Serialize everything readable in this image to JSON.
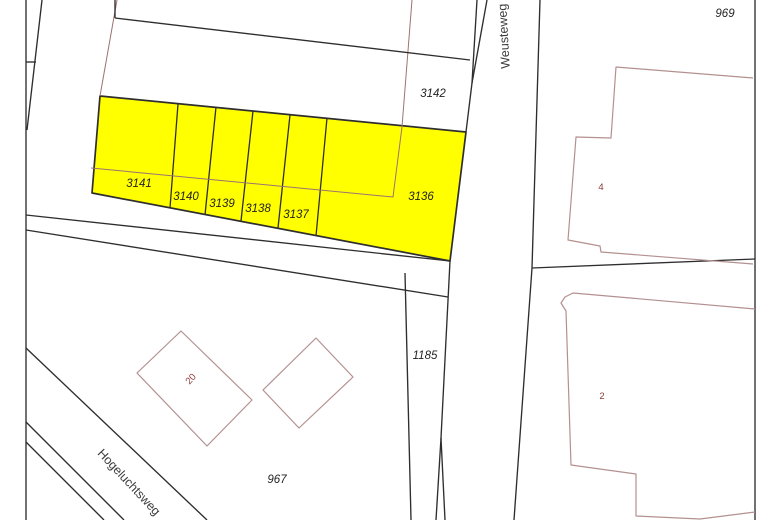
{
  "map": {
    "canvas": {
      "width": 780,
      "height": 520,
      "background": "#ffffff"
    },
    "colors": {
      "boundary": "#2e2e2e",
      "red_line": "#9b7272",
      "building": "#b49090",
      "highlight": "#ffff00",
      "parcel_label": "#232323",
      "house_label": "#8e3b3b",
      "street_label": "#3d3d3d"
    },
    "highlight": {
      "points": [
        [
          100,
          96
        ],
        [
          466,
          132
        ],
        [
          450,
          261
        ],
        [
          92,
          193
        ]
      ],
      "dividers": [
        [
          [
            178,
            104
          ],
          [
            170,
            208
          ]
        ],
        [
          [
            216,
            107
          ],
          [
            205,
            215
          ]
        ],
        [
          [
            253,
            111
          ],
          [
            241,
            221
          ]
        ],
        [
          [
            290,
            115
          ],
          [
            278,
            228
          ]
        ],
        [
          [
            327,
            118
          ],
          [
            316,
            236
          ]
        ]
      ]
    },
    "black_lines": [
      {
        "name": "left-boundary-vertical",
        "points": [
          [
            26,
            0
          ],
          [
            26,
            520
          ]
        ]
      },
      {
        "name": "left-diagonal",
        "points": [
          [
            42,
            0
          ],
          [
            27,
            130
          ]
        ]
      },
      {
        "name": "left-tick",
        "points": [
          [
            26,
            62
          ],
          [
            36,
            62
          ]
        ]
      },
      {
        "name": "top-left-vertical-tick",
        "points": [
          [
            115,
            0
          ],
          [
            115,
            18
          ]
        ]
      },
      {
        "name": "upper-parcel-boundary",
        "points": [
          [
            115,
            18
          ],
          [
            470,
            60
          ]
        ]
      },
      {
        "name": "road-left-edge-upper-a",
        "points": [
          [
            477,
            0
          ],
          [
            472,
            83
          ],
          [
            466,
            132
          ]
        ]
      },
      {
        "name": "road-left-edge-upper-b",
        "points": [
          [
            487,
            0
          ],
          [
            472,
            83
          ]
        ]
      },
      {
        "name": "road-right-edge",
        "points": [
          [
            540,
            0
          ],
          [
            532,
            268
          ],
          [
            514,
            520
          ]
        ]
      },
      {
        "name": "boundary-right-of-road",
        "points": [
          [
            532,
            268
          ],
          [
            755,
            259
          ]
        ]
      },
      {
        "name": "right-boundary-vertical",
        "points": [
          [
            755,
            0
          ],
          [
            755,
            520
          ]
        ]
      },
      {
        "name": "strip-line-a",
        "points": [
          [
            26,
            215
          ],
          [
            450,
            261
          ]
        ]
      },
      {
        "name": "strip-line-b",
        "points": [
          [
            26,
            230
          ],
          [
            448,
            297
          ]
        ]
      },
      {
        "name": "road-left-edge-lower",
        "points": [
          [
            450,
            261
          ],
          [
            441,
            438
          ],
          [
            445,
            520
          ]
        ]
      },
      {
        "name": "fork-branch-left",
        "points": [
          [
            441,
            438
          ],
          [
            436,
            520
          ]
        ]
      },
      {
        "name": "parcel-1185-left-boundary",
        "points": [
          [
            405,
            273
          ],
          [
            411,
            520
          ]
        ]
      },
      {
        "name": "hogeluchtsweg-edge-1",
        "points": [
          [
            26,
            348
          ],
          [
            207,
            520
          ]
        ]
      },
      {
        "name": "hogeluchtsweg-edge-2",
        "points": [
          [
            26,
            422
          ],
          [
            124,
            520
          ]
        ]
      },
      {
        "name": "hogeluchtsweg-edge-3",
        "points": [
          [
            26,
            442
          ],
          [
            104,
            520
          ]
        ]
      }
    ],
    "red_lines": [
      {
        "name": "red-boundary-left",
        "points": [
          [
            117,
            0
          ],
          [
            100,
            96
          ]
        ]
      },
      {
        "name": "red-boundary-through-parcels",
        "points": [
          [
            412,
            0
          ],
          [
            402,
            127
          ],
          [
            393,
            197
          ],
          [
            91,
            168
          ]
        ]
      }
    ],
    "buildings": [
      {
        "name": "building-4-outline",
        "closed": false,
        "points": [
          [
            753,
            78
          ],
          [
            616,
            67
          ],
          [
            611,
            138
          ],
          [
            576,
            137
          ],
          [
            568,
            240
          ],
          [
            600,
            246
          ],
          [
            601,
            252
          ],
          [
            753,
            264
          ]
        ]
      },
      {
        "name": "building-2-outline",
        "closed": false,
        "points": [
          [
            755,
            309
          ],
          [
            573,
            293
          ],
          [
            565,
            297
          ],
          [
            561,
            303
          ],
          [
            566,
            311
          ],
          [
            571,
            465
          ],
          [
            636,
            474
          ],
          [
            636,
            516
          ],
          [
            700,
            519
          ],
          [
            755,
            512
          ]
        ]
      },
      {
        "name": "building-20-outline",
        "closed": true,
        "points": [
          [
            181,
            331
          ],
          [
            252,
            400
          ],
          [
            207,
            446
          ],
          [
            137,
            373
          ]
        ]
      },
      {
        "name": "building-small-outline",
        "closed": true,
        "points": [
          [
            316,
            338
          ],
          [
            353,
            377
          ],
          [
            299,
            428
          ],
          [
            263,
            390
          ]
        ]
      }
    ],
    "parcel_labels": [
      {
        "text": "969",
        "x": 725,
        "y": 17
      },
      {
        "text": "3142",
        "x": 433,
        "y": 97
      },
      {
        "text": "3141",
        "x": 139,
        "y": 187
      },
      {
        "text": "3140",
        "x": 186,
        "y": 200
      },
      {
        "text": "3139",
        "x": 222,
        "y": 207
      },
      {
        "text": "3138",
        "x": 258,
        "y": 212
      },
      {
        "text": "3137",
        "x": 296,
        "y": 218
      },
      {
        "text": "3136",
        "x": 421,
        "y": 200
      },
      {
        "text": "1185",
        "x": 425,
        "y": 359
      },
      {
        "text": "967",
        "x": 277,
        "y": 483
      }
    ],
    "house_labels": [
      {
        "text": "4",
        "x": 601,
        "y": 190,
        "r": 0
      },
      {
        "text": "2",
        "x": 602,
        "y": 399,
        "r": 0
      },
      {
        "text": "20",
        "x": 193,
        "y": 381,
        "r": -48
      }
    ],
    "street_labels": [
      {
        "text": "Weusteweg",
        "x": 508,
        "y": 36,
        "r": -93
      },
      {
        "text": "Hogeluchtsweg",
        "x": 126,
        "y": 485,
        "r": 47
      }
    ]
  }
}
